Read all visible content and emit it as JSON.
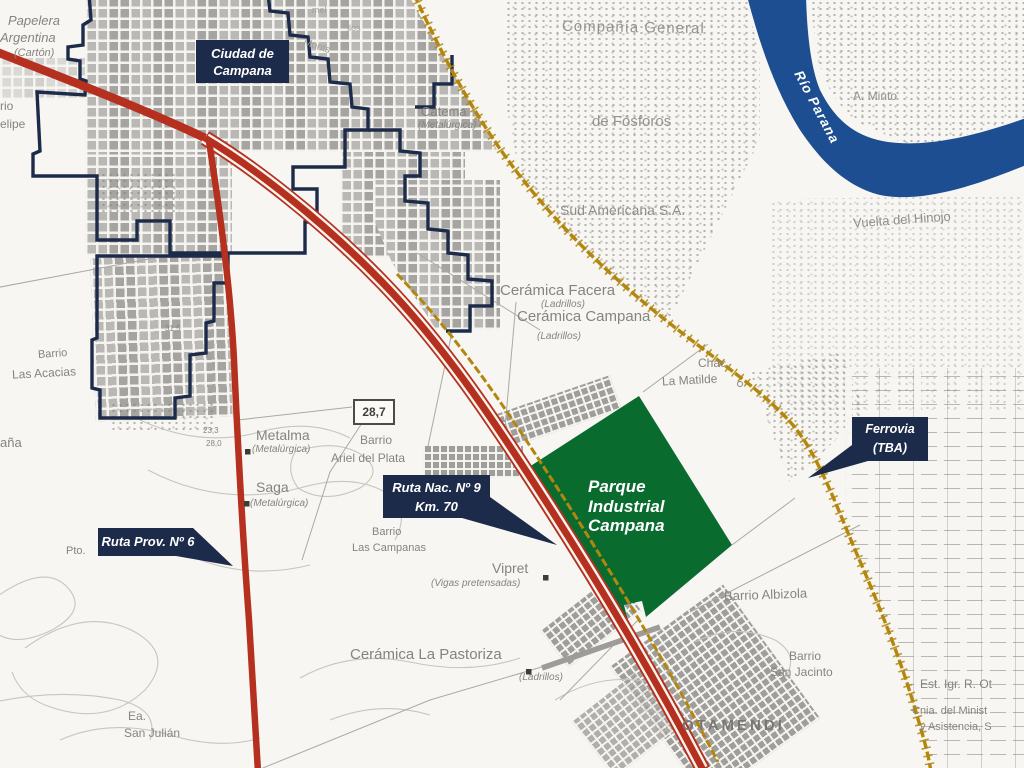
{
  "colors": {
    "navy": "#1c2b4a",
    "road_red": "#b5301f",
    "railway_gold": "#b3860e",
    "park_green": "#0a6b2f",
    "river_blue": "#1d4e91",
    "label_gray": "#85847f"
  },
  "city_box": {
    "line1": "Ciudad de",
    "line2": "Campana"
  },
  "callouts": {
    "ruta_nac": {
      "line1": "Ruta Nac. Nº 9",
      "line2": "Km. 70"
    },
    "ruta_prov": {
      "line1": "Ruta Prov. Nº 6"
    },
    "ferrovia": {
      "line1": "Ferrovia",
      "line2": "(TBA)"
    }
  },
  "park": {
    "line1": "Parque",
    "line2": "Industrial",
    "line3": "Campana"
  },
  "river": {
    "label": "Río Parana"
  },
  "labels": {
    "papelera1": "Papelera",
    "papelera2": "Argentina",
    "papelera3": "(Cartón)",
    "felipe1": "rio",
    "felipe2": "elipe",
    "compania1": "Compañía General",
    "compania2": "de Fósforos",
    "sud": "Sud Americana S.A.",
    "minto": "A. Minto",
    "vuelta": "Vuelta del Hinojo",
    "catema": "Catema",
    "catema_sub": "(Metalúrgica)",
    "facera": "Cerámica Facera",
    "facera_sub": "(Ladrillos)",
    "ceramica_campana": "Cerámica Campana",
    "ceramica_campana_sub": "(Ladrillos)",
    "chac": "Chac.",
    "matilde": "La Matilde",
    "metalma": "Metalma",
    "metalma_sub": "(Metalúrgica)",
    "saga": "Saga",
    "saga_sub": "(Metalúrgica)",
    "ariel1": "Barrio",
    "ariel2": "Ariel del Plata",
    "alt_287": "28,7",
    "alt_233": "23,3",
    "alt_280": "28,0",
    "alt_315": "31,5",
    "pto": "Pto.",
    "acacias1": "Barrio",
    "acacias2": "Las Acacias",
    "bana": "aña",
    "campanas1": "Barrio",
    "campanas2": "Las Campanas",
    "vipret": "Vipret",
    "vipret_sub": "(Vigas pretensadas)",
    "pastoriza": "Cerámica La Pastoriza",
    "pastoriza_sub": "(Ladrillos)",
    "albizola": "Barrio Albizola",
    "jacinto1": "Barrio",
    "jacinto2": "San Jacinto",
    "otamendi": "OTAMENDI",
    "ea1": "Ea.",
    "ea2": "San Julián",
    "est": "Est. Igr. R. Ot",
    "cnia": "Cnia. del Minist",
    "asist": "y Asistencia, S",
    "street1": "mel",
    "street2": "Monts",
    "street3": "llos"
  }
}
